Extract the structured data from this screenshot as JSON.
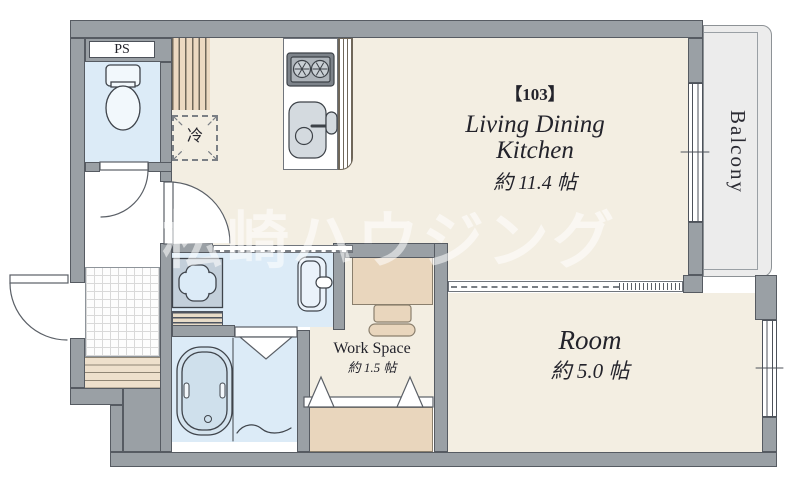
{
  "unit": {
    "number_label": "【103】"
  },
  "rooms": {
    "ldk": {
      "label_line1": "Living Dining",
      "label_line2": "Kitchen",
      "area": "約 11.4 帖"
    },
    "bedroom": {
      "label": "Room",
      "area": "約 5.0 帖"
    },
    "workspace": {
      "label": "Work Space",
      "area": "約 1.5 帖"
    },
    "balcony": {
      "label": "Balcony"
    },
    "pipe_space": {
      "label": "PS"
    },
    "refrigerator_space": {
      "label": "冷"
    }
  },
  "watermark": {
    "text": "松崎ハウジング"
  },
  "icons": [
    "toilet-icon",
    "bathtub-icon",
    "washing-machine-pan-icon",
    "vanity-sink-icon",
    "gas-stove-icon",
    "kitchen-sink-icon",
    "refrigerator-space-icon",
    "desk-icon",
    "chair-icon",
    "door-swing-icon",
    "folding-door-icon",
    "sliding-door-icon",
    "window-icon"
  ],
  "colors": {
    "wall": "#9aa0a5",
    "floor_main": "#f3eee2",
    "floor_wet": "#dcebf7",
    "wood": "#e9d6bd",
    "balcony": "#ececec",
    "line": "#4d525a",
    "text": "#23232b",
    "watermark": "rgba(255,255,255,0.55)"
  }
}
